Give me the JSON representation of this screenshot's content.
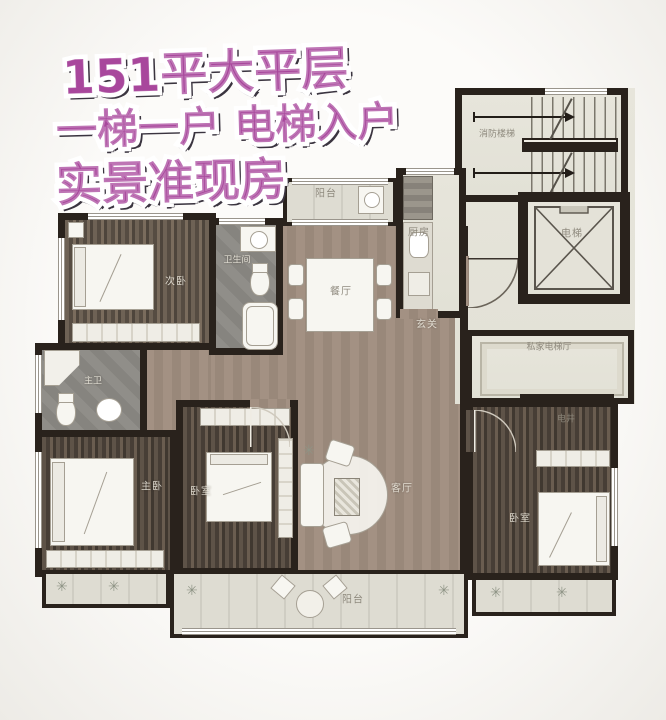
{
  "overlay": {
    "line1": "151平大平层",
    "line2": "一梯一户 电梯入户",
    "line3": "实景准现房"
  },
  "floorplan": {
    "rooms": {
      "bedroom_secondary": {
        "label": "次卧"
      },
      "bathroom_guest": {
        "label": "卫生间"
      },
      "balcony_top": {
        "label": "阳台"
      },
      "dining": {
        "label": "餐厅"
      },
      "kitchen": {
        "label": "厨房"
      },
      "entry_hall": {
        "label": "玄关"
      },
      "fire_stairs": {
        "label": "消防楼梯"
      },
      "elevator": {
        "label": "电梯"
      },
      "private_elevator_hall": {
        "label": "私家电梯厅"
      },
      "utility_shaft": {
        "label": "电井"
      },
      "master_bath": {
        "label": "主卫"
      },
      "master_bedroom": {
        "label": "主卧"
      },
      "bedroom_middle": {
        "label": "卧室"
      },
      "living": {
        "label": "客厅"
      },
      "balcony_bottom": {
        "label": "阳台"
      },
      "bedroom_right": {
        "label": "卧室"
      }
    }
  },
  "palette": {
    "overlay_fill": "#a8479c",
    "overlay_outline": "#ffffff",
    "overlay_shadow": "#3b3540",
    "wall": "#29221c",
    "wood_floor": "#675c50",
    "living_floor": "#a09080",
    "bath_floor": "#8a8884",
    "public_floor": "#e6e4da",
    "balcony_floor": "#dcdad0",
    "furniture": "#f7f6f1"
  }
}
